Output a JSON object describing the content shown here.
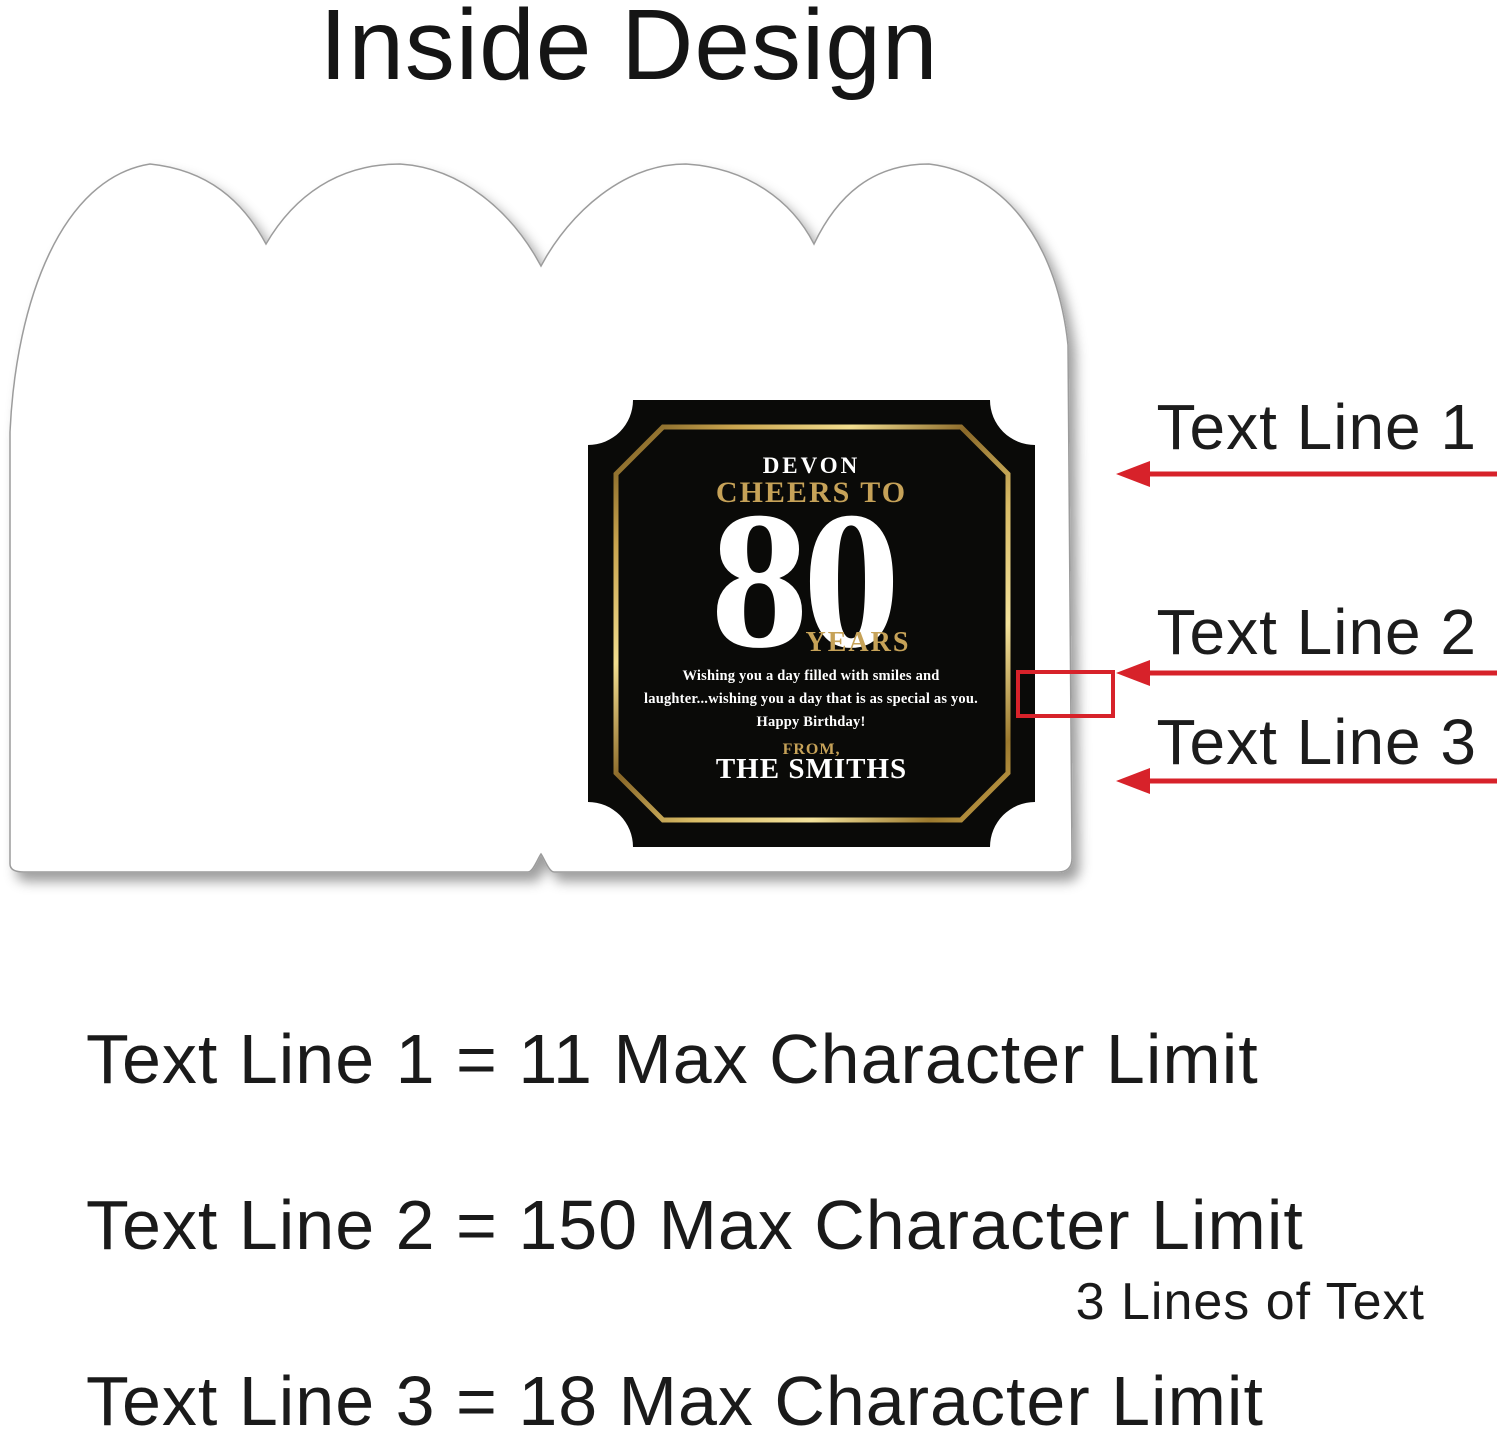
{
  "title": "Inside Design",
  "card": {
    "plaque": {
      "name_line": "DEVON",
      "heading": "CHEERS TO",
      "age": "80",
      "age_suffix": "YEARS",
      "message": [
        "Wishing you a day filled with smiles and",
        "laughter...wishing you a day that is as special as you.",
        "Happy Birthday!"
      ],
      "from_label": "FROM,",
      "from_name": "THE SMITHS"
    }
  },
  "annotations": {
    "line1_label": "Text Line 1",
    "line2_label": "Text Line 2",
    "line3_label": "Text Line 3"
  },
  "limits": {
    "line1": "Text Line 1 = 11 Max Character Limit",
    "line2": "Text Line 2 = 150 Max Character Limit",
    "line2_note": "3 Lines of Text",
    "line3": "Text Line 3 = 18 Max Character Limit"
  },
  "colors": {
    "accent_red": "#D7222A",
    "gold_text": "#C6A258",
    "plaque_black": "#0A0A08",
    "card_outline": "#9C9C9C"
  }
}
